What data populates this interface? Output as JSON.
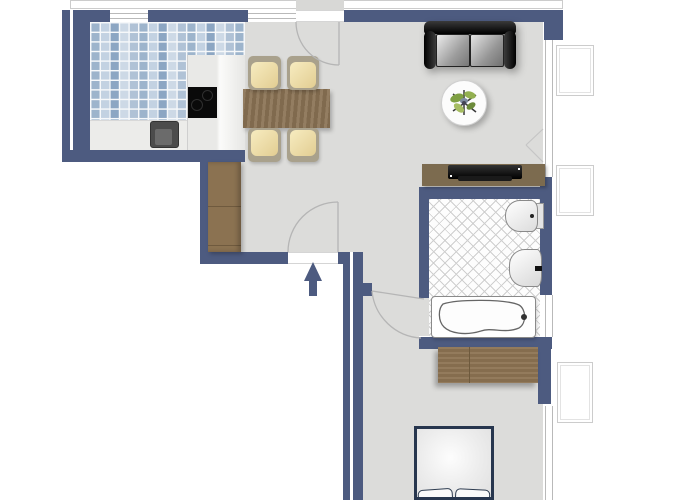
{
  "meta": {
    "type": "floor-plan",
    "view": "top-down",
    "description": "One-bedroom apartment floor plan with open kitchen/dining/living area, bathroom and bedroom"
  },
  "colors": {
    "wall": "#4d5b80",
    "floor": "#dcdcda",
    "outside": "#ffffff",
    "wood": "#8a7254",
    "wood_dark": "#7c6b4f",
    "wood_mid": "#8b7251",
    "chair_seat": "#eedfac",
    "chair_frame": "#a9a18c",
    "bed_frame": "#27364e",
    "tile_base": "#dfe7ef",
    "arrow": "#4d5b80"
  },
  "rooms": [
    {
      "id": "kitchen",
      "floor": "blue-mosaic-tile",
      "furniture": [
        "l-shaped-counter",
        "cooktop",
        "kitchen-sink"
      ]
    },
    {
      "id": "dining-area",
      "floor": "grey",
      "furniture": [
        "dining-table",
        "chair",
        "chair",
        "chair",
        "chair"
      ]
    },
    {
      "id": "living-room",
      "floor": "grey",
      "furniture": [
        "sofa",
        "round-side-table",
        "plant",
        "tv-sideboard",
        "hall-wardrobe"
      ]
    },
    {
      "id": "bathroom",
      "floor": "diagonal-hatch-tile",
      "furniture": [
        "toilet",
        "washbasin",
        "bathtub"
      ]
    },
    {
      "id": "bedroom",
      "floor": "grey",
      "furniture": [
        "wardrobe",
        "double-bed"
      ]
    }
  ],
  "openings": {
    "entrance": {
      "location": "south-wall",
      "symbol": "arrow-up"
    },
    "doors": [
      "top-wall-door-with-swing-arc",
      "entrance-door-with-swing-arc",
      "bathroom-door-with-swing-arc"
    ],
    "windows": [
      "kitchen-north-window",
      "north-window-beside-door",
      "living-east-window",
      "bathtub-east-window",
      "bedroom-east-window"
    ],
    "exterior_sills": 4
  }
}
